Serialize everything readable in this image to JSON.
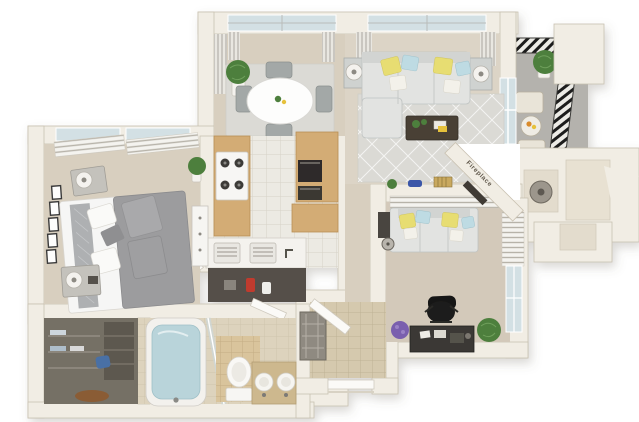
{
  "meta": {
    "type": "3d-apartment-floor-plan-rendering"
  },
  "labels": {
    "fireplace": "Fireplace"
  },
  "palette": {
    "bg": "#ffffff",
    "wall": "#f1ede4",
    "wall_edge": "#c9c1b1",
    "wall_shadow": "#ddd6c8",
    "floor_beige": "#d8cfbf",
    "floor_living": "#dcd4c6",
    "floor_den": "#d3c9ba",
    "tile_white": "#eceae3",
    "tile_line": "#d6d2c7",
    "tile_beige": "#ddd3bd",
    "tile_line2": "#cec4ad",
    "tile_tan": "#d9c49c",
    "tile_tan_line": "#c4ad83",
    "tile_entry": "#d5c9ae",
    "tile_entry_line": "#beb295",
    "rug_gray": "#dbdad5",
    "rug_line": "#f4f4f2",
    "sofa_gray": "#e2e3e1",
    "sofa_back": "#d2d4d2",
    "sofa_shadow": "#bfc3c2",
    "pillow_yellow": "#e7dd72",
    "pillow_blue": "#bedbe3",
    "bed_gray": "#9c9c9e",
    "bed_white": "#f6f6f5",
    "wood_tan": "#d3ac74",
    "wood_dark": "#b98f55",
    "plant_green": "#4e7f3e",
    "plant_purple": "#7a5fae",
    "dark_furniture": "#36322e",
    "chair_gray": "#a3a8a7",
    "balcony_floor": "#b4b2ad",
    "rail_bg": "#ecebe6",
    "rail_dark": "#1d1d1b",
    "glass_blue": "#d3e0e4",
    "water_blue": "#b9d4da",
    "closet_dark": "#756f65",
    "slat_bg": "#f4f3ef",
    "slat_line": "#b7b3a9",
    "curtain_bg": "#e9e7e1",
    "curtain_line": "#a9a6a0",
    "accent_orange": "#d98a2b",
    "accent_red": "#c03b2d",
    "label_text": "#5f574a"
  },
  "rooms": [
    {
      "id": "dining-area",
      "furniture": [
        "round-dining-table",
        "dining-chair",
        "dining-chair",
        "dining-chair",
        "dining-chair",
        "area-rug",
        "potted-plant",
        "window-curtains"
      ]
    },
    {
      "id": "living-room",
      "furniture": [
        "sectional-sofa",
        "accent-pillows",
        "geometric-rug",
        "coffee-table",
        "end-table",
        "end-table",
        "table-lamp",
        "table-lamp",
        "window-curtains",
        "balcony-slider"
      ]
    },
    {
      "id": "balcony",
      "furniture": [
        "bistro-chair",
        "bistro-chair",
        "bistro-table",
        "potted-plant",
        "metal-railing"
      ]
    },
    {
      "id": "bedroom",
      "furniture": [
        "bed",
        "nightstand",
        "nightstand",
        "table-lamp",
        "table-lamp",
        "gallery-wall-frames",
        "dresser",
        "potted-plant",
        "window-blinds"
      ]
    },
    {
      "id": "kitchen",
      "furniture": [
        "range-stove",
        "refrigerator",
        "tall-cabinets",
        "wall-oven",
        "microwave",
        "counter",
        "double-basin-sink",
        "faucet",
        "open-cabinet"
      ]
    },
    {
      "id": "den-office",
      "furniture": [
        "sofa",
        "accent-pillows",
        "desk",
        "office-chair",
        "desk-plant",
        "floor-plant",
        "window-blinds",
        "decor-shelf",
        "side-table",
        "fan",
        "fireplace"
      ]
    },
    {
      "id": "bathroom",
      "furniture": [
        "bathtub",
        "glass-door",
        "toilet",
        "double-sink-vanity",
        "walk-in-closet",
        "closet-rug"
      ]
    },
    {
      "id": "entry",
      "furniture": [
        "front-door",
        "open-door",
        "shelf-unit",
        "exterior-step"
      ]
    }
  ]
}
